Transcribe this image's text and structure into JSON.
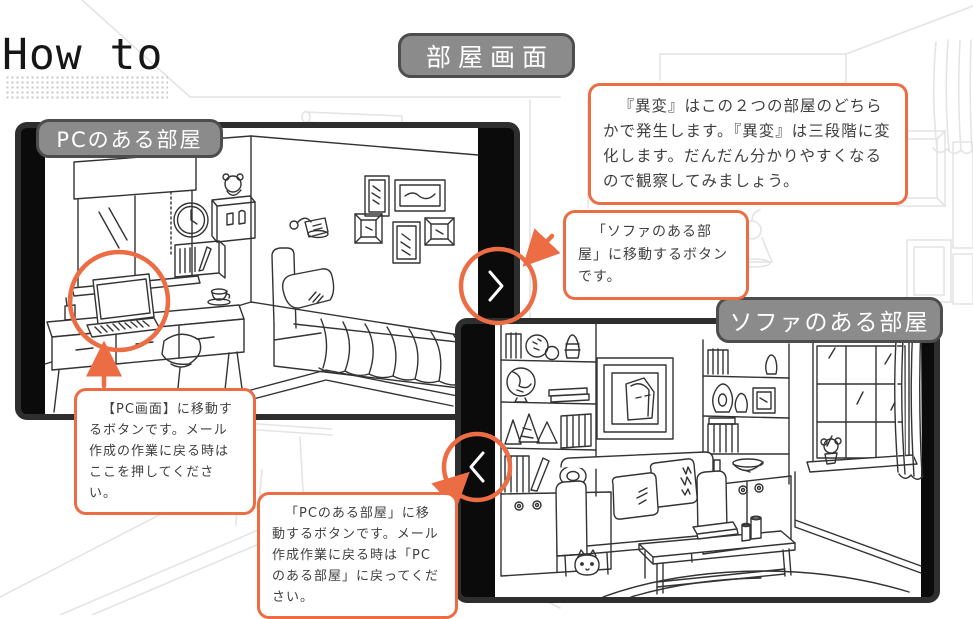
{
  "title": "How to",
  "header_label": "部屋画面",
  "panels": {
    "pc_room": {
      "label": "PCのある部屋"
    },
    "sofa_room": {
      "label": "ソファのある部屋"
    }
  },
  "icons": {
    "pc_room_nav": "chevron-right-icon",
    "sofa_room_nav": "chevron-left-icon"
  },
  "callouts": {
    "anomaly_note": "『異変』はこの２つの部屋のどちらかで発生します。『異変』は三段階に変化します。だんだん分かりやすくなるので観察してみましょう。",
    "sofa_button_note": "「ソファのある部屋」に移動するボタンです。",
    "pc_screen_button_note": "【PC画面】に移動するボタンです。メール作成の作業に戻る時はここを押してください。",
    "pc_room_button_note": "「PCのある部屋」に移動するボタンです。メール作成作業に戻る時は「PCのある部屋」に戻ってください。"
  },
  "colors": {
    "accent_orange": "#EC6C44",
    "label_gray": "#8B8B8B",
    "label_border": "#4D4D4D",
    "panel_frame": "#2E2E2E",
    "line_art": "#333333",
    "background_line": "#E4E4E4",
    "text": "#404040"
  }
}
